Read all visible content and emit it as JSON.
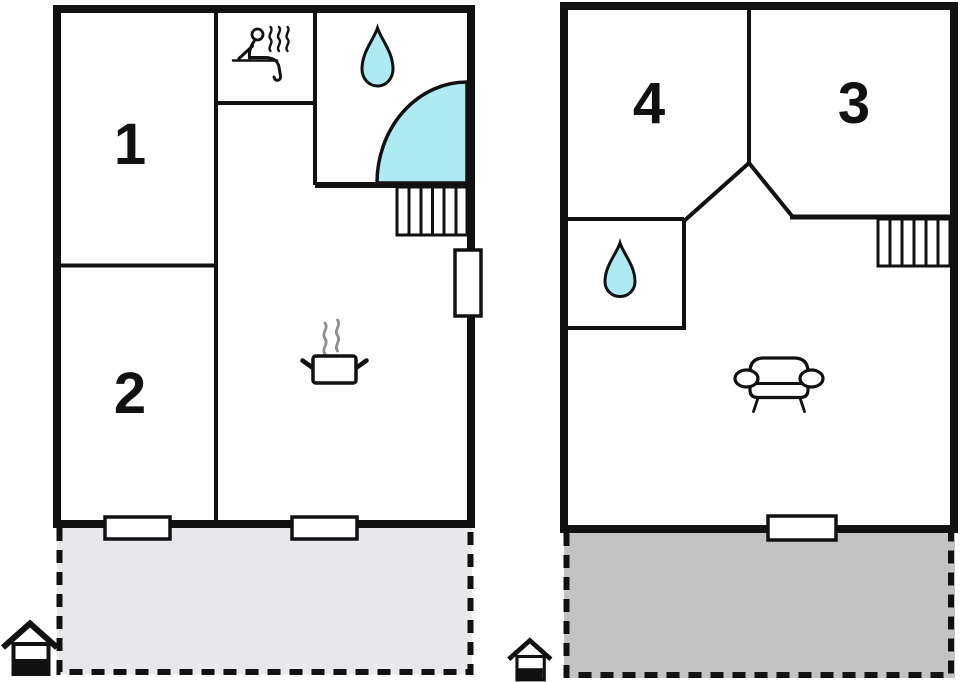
{
  "diagram": {
    "type": "floor-plan",
    "floors": 2
  },
  "colors": {
    "wall": "#111111",
    "water": "#aeeaf2",
    "terrace_ground": "#e8e8ec",
    "terrace_upper": "#c3c3c3",
    "steam": "#909090"
  },
  "ground_floor": {
    "rooms": [
      {
        "label": "1"
      },
      {
        "label": "2"
      }
    ],
    "features": [
      "sauna-icon",
      "water-drop-icon",
      "shower-icon",
      "stairs-icon",
      "cooking-pot-icon",
      "terrace",
      "windows",
      "house-entrance-icon"
    ]
  },
  "upper_floor": {
    "rooms": [
      {
        "label": "4"
      },
      {
        "label": "3"
      }
    ],
    "features": [
      "water-drop-icon",
      "stairs-icon",
      "sofa-icon",
      "balcony",
      "window",
      "house-entrance-icon"
    ]
  }
}
